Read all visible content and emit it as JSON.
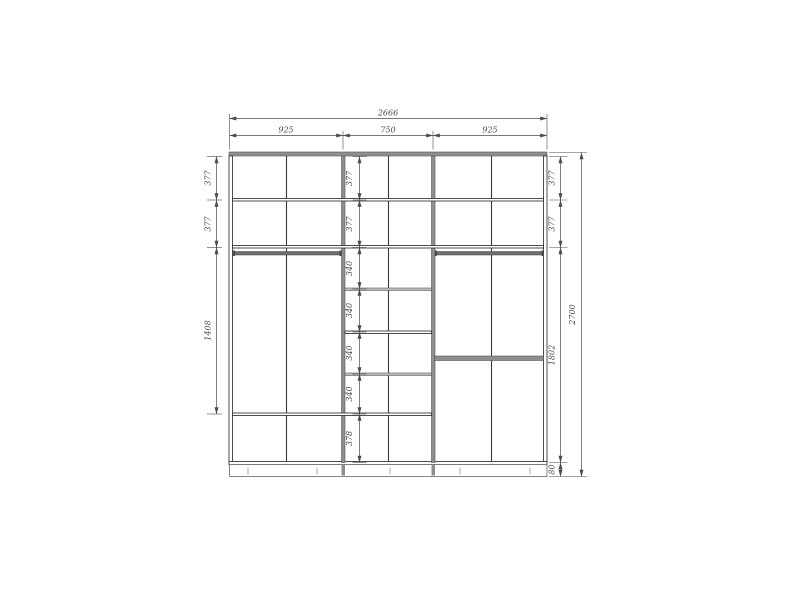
{
  "drawing": {
    "width_total": "2666",
    "width_sections": [
      "925",
      "750",
      "925"
    ],
    "left_heights": [
      "377",
      "377",
      "1408"
    ],
    "middle_heights": [
      "377",
      "377",
      "340",
      "340",
      "340",
      "340",
      "378"
    ],
    "right_heights": [
      "377",
      "377",
      "1802",
      "80"
    ],
    "height_total": "2700"
  },
  "colors": {
    "line": "#3a3a3a",
    "dim": "#4a4a4a",
    "panel": "#8f8f8f",
    "panellight": "#bdbdbd",
    "rod": "#6e6e6e",
    "bg": "#ffffff"
  }
}
